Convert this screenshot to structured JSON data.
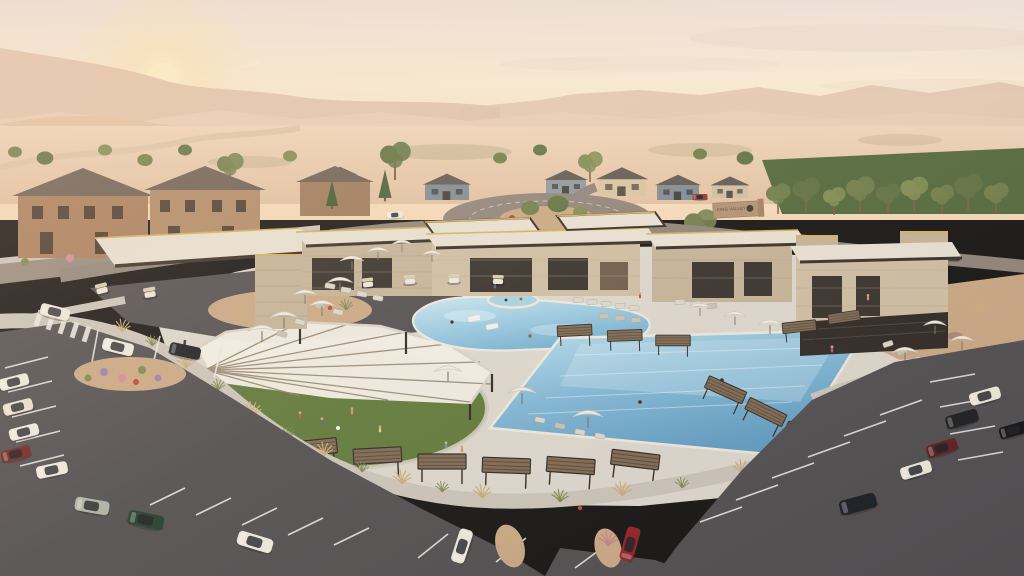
{
  "scene": {
    "type": "aerial architectural rendering",
    "subject": "desert community amenity center with resort pools at sunset",
    "time_of_day": "sunset",
    "monument_sign": {
      "text": "KING VALLEY"
    },
    "features": {
      "pools": [
        "freeform lagoon pool",
        "rectangular lap pool",
        "round spa"
      ],
      "structures": [
        "flat-roof stone clubhouse buildings",
        "porte-cochere canopy",
        "fan shade canopy over event lawn",
        "slat-roof cabanas"
      ],
      "site": [
        "roundabout with landscaped island",
        "curved promenade",
        "two parking lots",
        "golf cart parking",
        "craftsman homes",
        "desert mountains"
      ]
    },
    "counts": {
      "umbrellas": 16,
      "cabanas": 13,
      "parked_cars": 16,
      "road_cars": 4,
      "golf_carts": 6,
      "people_visible": 14
    }
  },
  "palette": {
    "sky_top": "#ece1dc",
    "sky_mid": "#f8ecd6",
    "sky_low": "#f6dfc0",
    "sun": "#fdf0c8",
    "cloud": "#e8d8d0",
    "mtn_far": "#dfc2ac",
    "mtn_mid": "#e9cfb8",
    "mtn_near": "#e4c3a5",
    "valley": "#ebd1b5",
    "tree_dark": "#5e7242",
    "tree_mid": "#6f7f4a",
    "tree_light": "#7e8d54",
    "lawn": "#5d7839",
    "park_lawn": "#50683c",
    "road": "#8e847b",
    "asphalt": "#4e4d50",
    "stripe": "#e9e9e7",
    "sidewalk": "#cbc5bb",
    "deck": "#dcd8cf",
    "stone": "#c3b49a",
    "stone_light": "#cdbfa5",
    "roof_slab": "#e8e2d5",
    "fascia": "#352d25",
    "gold_trim": "#d4b35e",
    "glass": "#332f2b",
    "water_light": "#bfe6f4",
    "water_deep": "#5e9cc3",
    "umbrella": "#f2efe7",
    "cabana_top": "#7b6853",
    "cabana_slat": "#574837",
    "frame_dark": "#2c2723",
    "gravel": "#c9a886",
    "boulder": "#a98c72",
    "grass_gold": "#c9ad7c",
    "shrub_green": "#7b8a4e",
    "flower_red": "#b5473a",
    "flower_purple": "#9a7fae",
    "flower_pink": "#d4899b",
    "house_tan": "#a87e5e",
    "house_blue": "#7d8c96",
    "house_cream": "#d8c6a4",
    "roof_dark": "#5f5952",
    "car_white": "#efeae0",
    "car_black": "#1a1c1f",
    "car_red": "#8f1f24",
    "car_green": "#1d3b2a",
    "car_sage": "#aab3a4",
    "car_navy": "#181c26",
    "car_darkred": "#6e2320",
    "car_silver": "#d9d6d0"
  }
}
